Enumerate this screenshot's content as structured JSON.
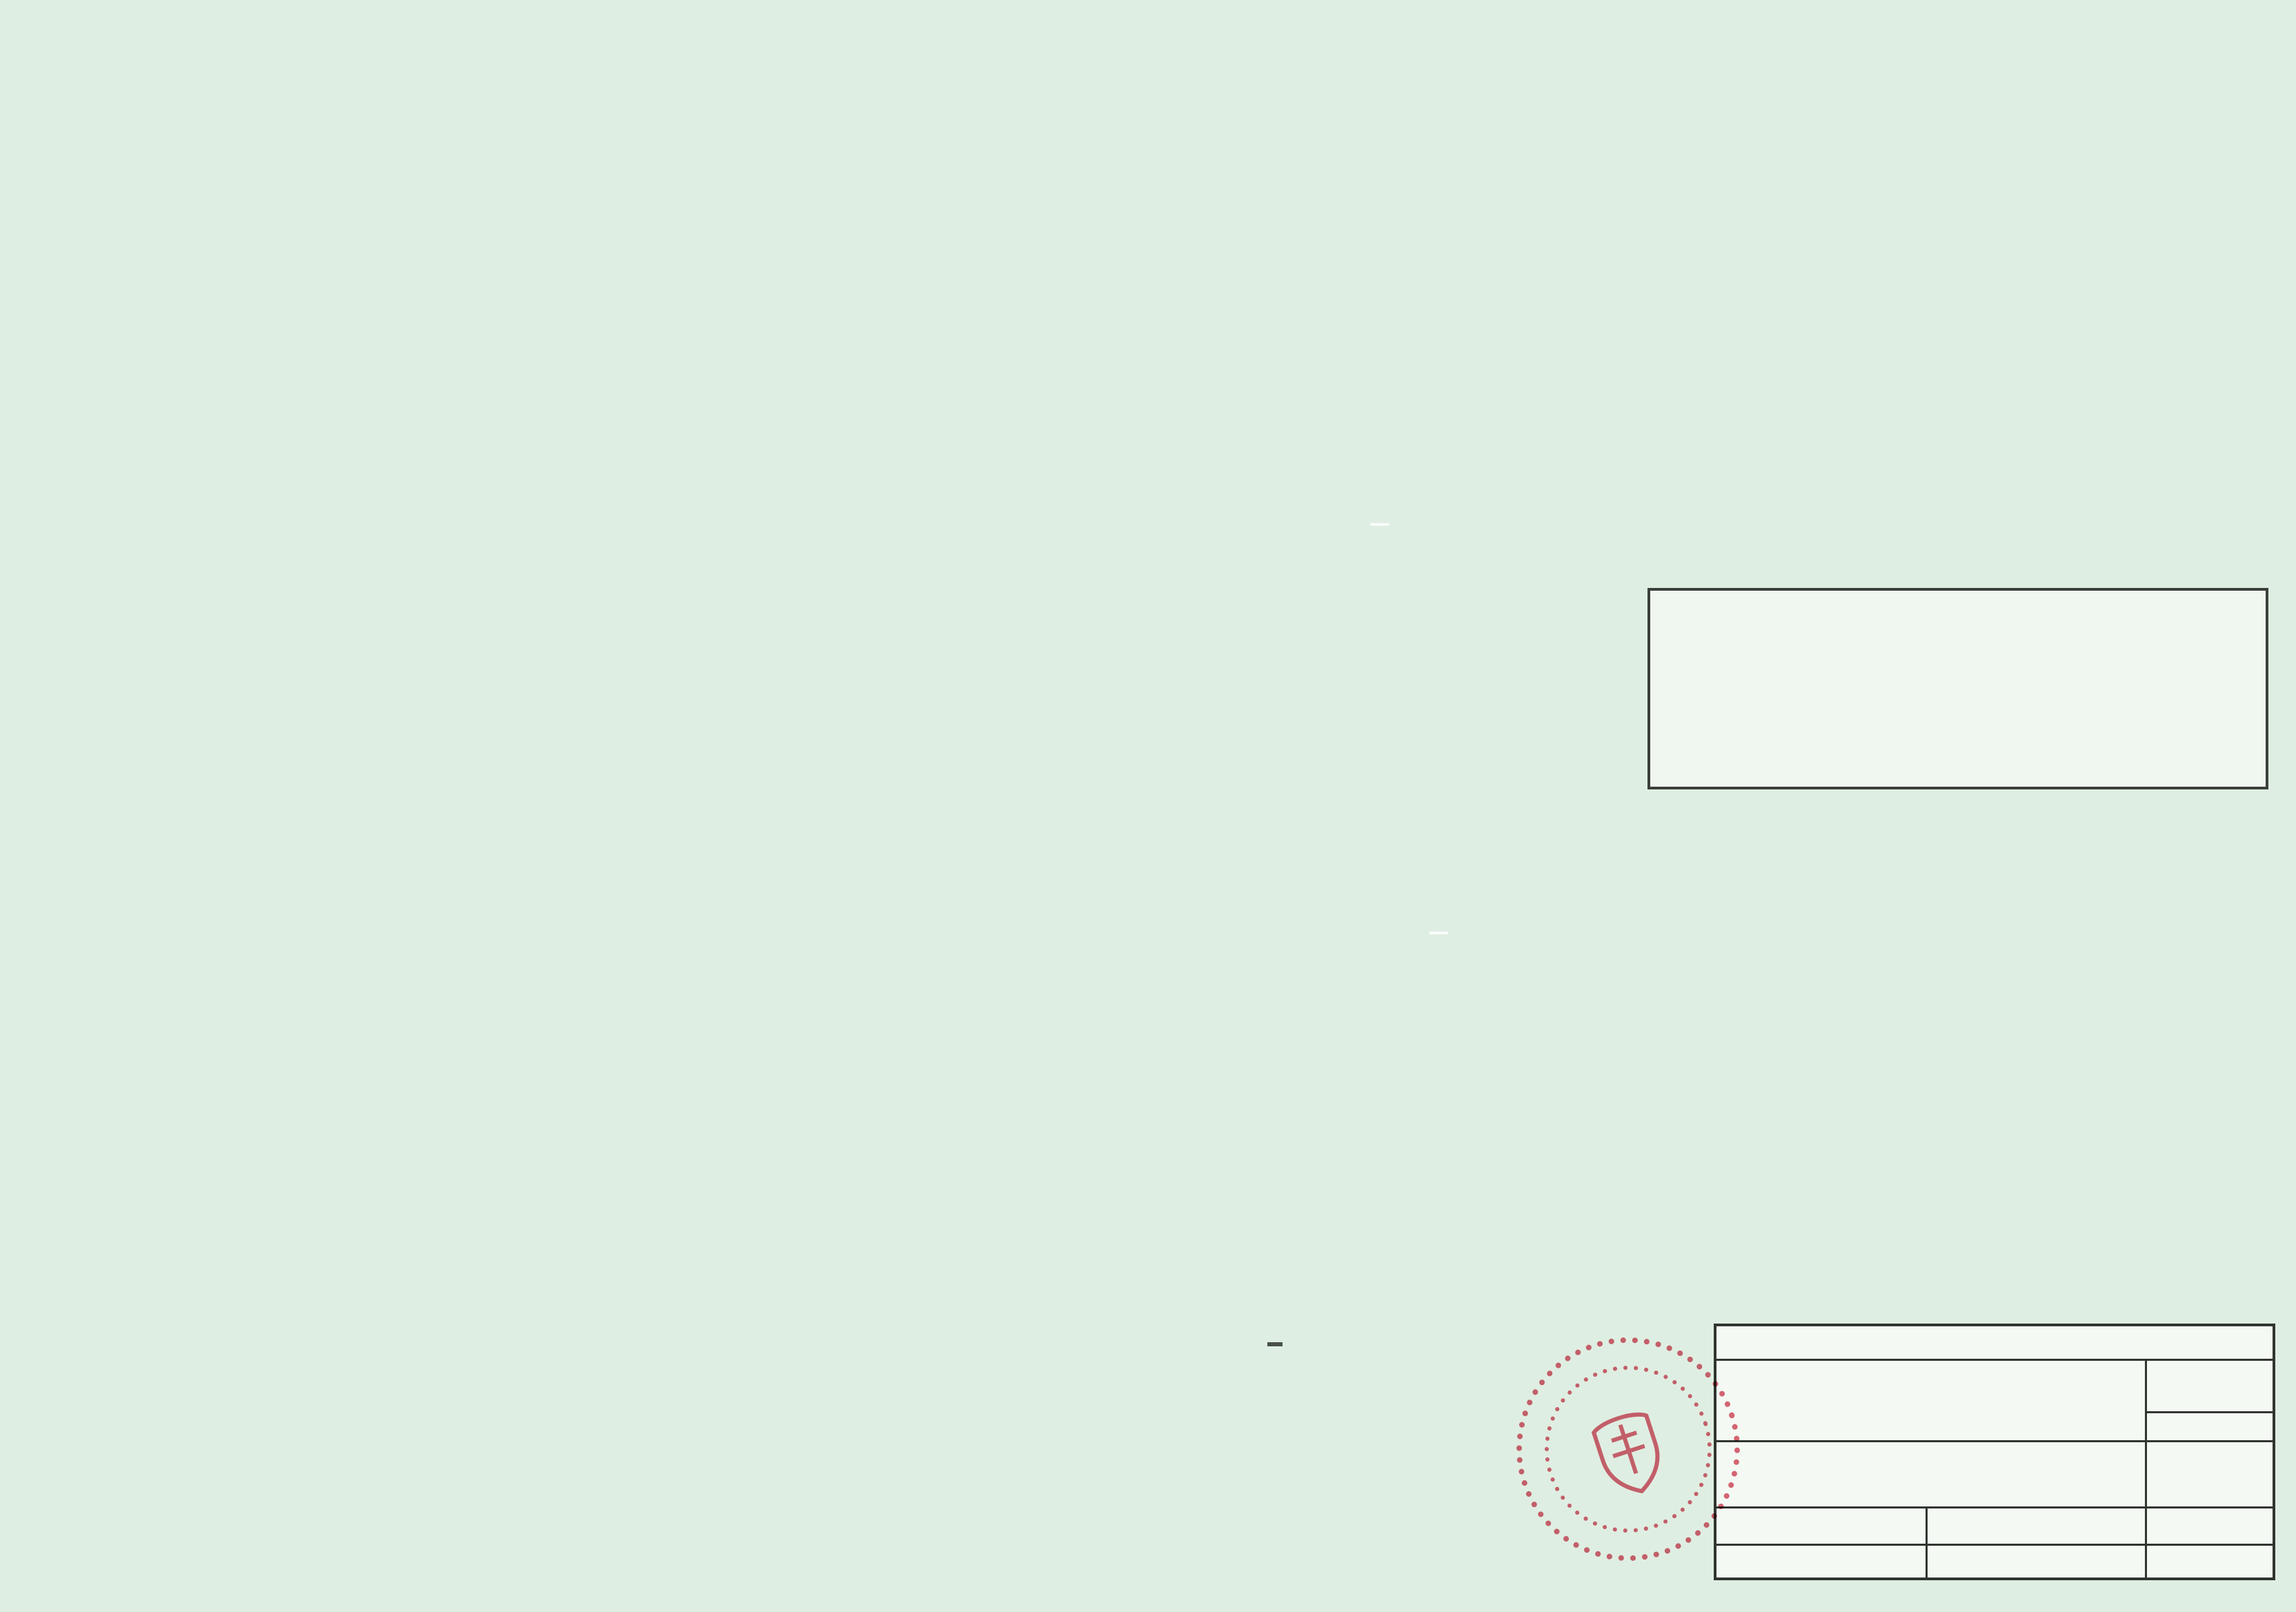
{
  "colors": {
    "red_label": "#c8472b",
    "salmon_label": "#d98f70",
    "bpej_green": "#3ab54a",
    "boundary_red": "#c0392b",
    "dashed_orange": "#dd8a66",
    "stamp_red": "#d84b5e"
  },
  "map": {
    "settlements": {
      "podlipa": "Podlipa",
      "zabava": "Zábava"
    },
    "roads": {
      "vs3": "VS3",
      "vs6": "VS6",
      "d1": "D1",
      "iii066": "III/066"
    },
    "parcels": {
      "d14": "D 1/4",
      "d15": "D 1/5",
      "d16": "D 1/6",
      "d17": "D 1/7"
    },
    "reg_numbers": {
      "r13": "1/3",
      "r14": "1/4",
      "r15": "1/5",
      "r16": "1/6",
      "r17": "1/7"
    },
    "bpej_codes": {
      "top": "0883682",
      "mid": "0865422",
      "bottom": "0883682"
    },
    "zones": {
      "b": "B",
      "c1": "C1"
    },
    "house_number": "44"
  },
  "title_box": {
    "line1": "ZMENY A DOPLNKY č.1.",
    "line2": "K ÚPN O ĽUBIETOVÁ",
    "line3": "Časť: D"
  },
  "legend": {
    "columns": {
      "stav": "stav",
      "navrh": "návrh",
      "vyhlad": "výhľad"
    },
    "rows": [
      "Hranica zastavaného územia",
      "Hranica riešeného územia",
      "Navrhovaná funkcia bývania",
      "Navrhovaná agrofarma",
      "Číslo regulovanej plochy",
      "Hranica BPEJ",
      "Kód BPEJ",
      "Záber poľnohospodárskej pôdy"
    ],
    "samples": {
      "reg_code": "D 1/5",
      "bpej_code": "0771211",
      "zaber": "1/5"
    }
  },
  "title_block": {
    "company_line1": "ING. ARCH. VLADIMÍR PAŠKO - PROJEKCIA URBANIZMU A ARCHITEKTÚRY",
    "company_line2": "TULSKÁ 97, 974 04 BANSKÁ BYSTRICA TEL.: 048 413 17 39",
    "nazov_dokumentu_label": "NÁZOV DOKUMENTU:",
    "nazov_dokumentu_line1": "ZMENY A DOPLNKY Č.1. K ÚPN O",
    "nazov_dokumentu_line2": "ĽUBIETOVÁ",
    "cislo_vykresu_label": "ČÍSLO VÝKRESU:",
    "drawing_number": "4 D",
    "nazov_vykresu_label": "NÁZOV VÝKRESU:",
    "nazov_vykresu_line1": "VYHODNOTENIE DÔSLEDKOV STAVEBNÝCH",
    "nazov_vykresu_line2": "A INÝCH ZÁMEROV NA PP A LP",
    "profesia_label": "PROFESIA:",
    "sidlo_label": "SÍDLO:",
    "sidlo": "ĽUBIETOVÁ",
    "zodpovedny_label": "ZODPOVEDNÝ PROJEKTANT:",
    "zodpovedny": "ING. ARCH. V. PAŠKO",
    "mierka_label": "MIERKA:",
    "mierka": "1 : 2 000",
    "okres_label": "OKRES:",
    "okres": "BANSKÁ BYSTRICA",
    "spracoval_label": "SPRACOVAL:",
    "datum_label": "DÁTUM:",
    "datum": "I.2016"
  },
  "stamp": {
    "name": "Ing. arch. Vladimír PAŠKO",
    "title": "autorizovaný architekt",
    "number": "0830 AA"
  }
}
